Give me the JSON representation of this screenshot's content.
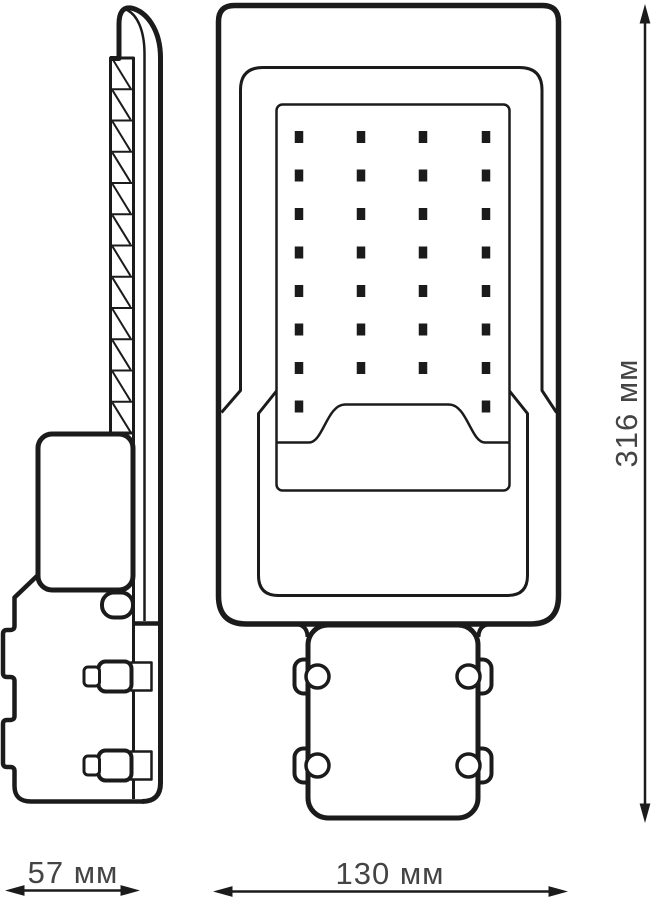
{
  "colors": {
    "line": "#1b1b1b",
    "dimension_text": "#444444",
    "background": "#ffffff"
  },
  "dimensions": {
    "height_label": "316 мм",
    "side_width_label": "57 мм",
    "front_width_label": "130 мм"
  },
  "led_grid": {
    "columns": 4,
    "full_rows": 7,
    "partial_row_dots": 2,
    "total_leds": 30,
    "col_x": [
      299,
      361,
      423,
      486
    ],
    "row_y": [
      137,
      175.5,
      214,
      252.5,
      291,
      329.5,
      368
    ],
    "last_row_y": 406.5,
    "last_row_cols": [
      299,
      486
    ],
    "dot_w": 8.5,
    "dot_h": 12
  }
}
